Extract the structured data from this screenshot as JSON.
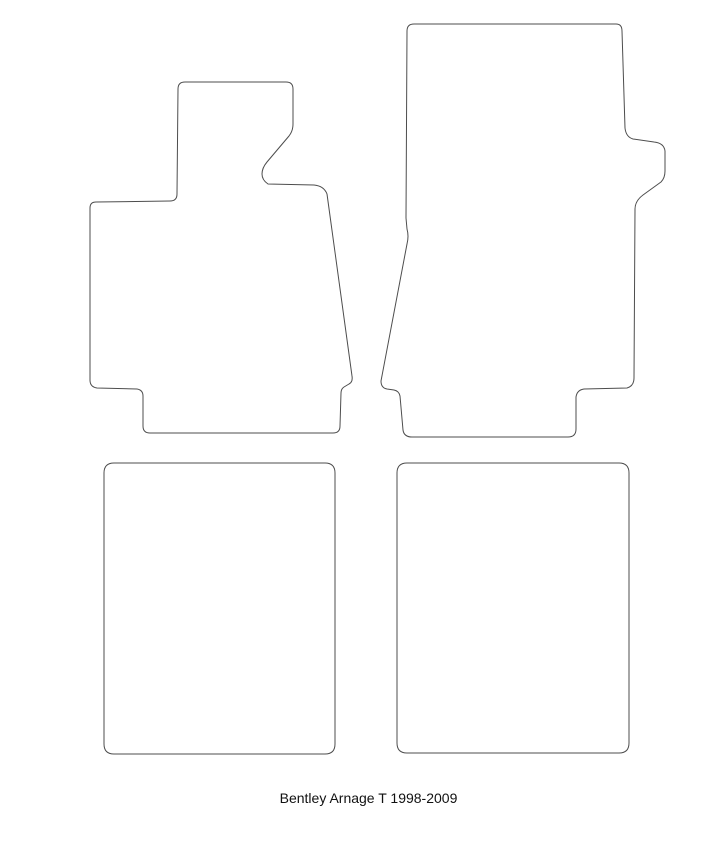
{
  "page": {
    "background_color": "#ffffff",
    "width_px": 723,
    "height_px": 853
  },
  "caption": {
    "text": "Bentley Arnage T 1998-2009"
  },
  "diagram": {
    "stroke_color": "#4d4d4d",
    "fill_color": "#ffffff",
    "mats": {
      "front_left": {
        "d": "M 185,82 L 286,82 Q 293,82 293,89 L 293,124 Q 293,131 289,136 L 267,162 Q 262,168 262,174 Q 262,180 268,184 L 314,185 Q 324,186 327,194 L 352,376 Q 353,382 349,384 L 344,387 Q 341,389 341,393 L 340,426 Q 340,433 333,433 L 150,433 Q 143,433 143,426 L 143,396 Q 143,390 137,389 L 97,388 Q 90,387 90,380 L 90,208 Q 90,202 96,202 L 170,201 Q 177,201 177,194 L 178,89 Q 178,82 185,82 Z"
      },
      "front_right": {
        "d": "M 414,24 L 616,24 Q 622,24 622,31 L 625,128 Q 626,137 633,139 L 654,142 Q 664,143 665,151 L 665,171 Q 665,178 661,182 L 643,195 Q 635,201 635,209 L 634,378 Q 634,386 627,388 L 584,389 Q 577,390 576,397 L 576,429 Q 576,437 568,437 L 412,437 Q 404,437 403,430 L 400,396 Q 399,391 394,390 L 387,389 Q 381,388 381,381 L 407,244 Q 409,236 407,229 L 406,218 L 407,31 Q 407,24 414,24 Z"
      },
      "rear_left": {
        "d": "M 114,463 L 325,463 Q 335,463 335,473 L 335,744 Q 335,754 325,754 L 114,754 Q 104,754 104,744 L 104,473 Q 104,463 114,463 Z"
      },
      "rear_right": {
        "d": "M 407,463 L 619,463 Q 629,463 629,473 L 629,743 Q 629,753 619,753 L 407,753 Q 397,753 397,743 L 397,473 Q 397,463 407,463 Z"
      }
    }
  }
}
